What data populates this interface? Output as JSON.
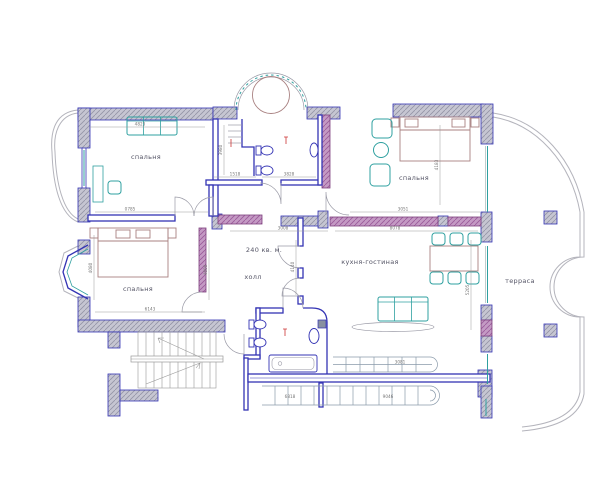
{
  "plan": {
    "area_label": "240 кв. м.",
    "rooms": {
      "bedroom_top_left": "спальня",
      "bedroom_top_right": "спальня",
      "bedroom_left": "спальня",
      "hall": "холл",
      "kitchen_living": "кухня-гостиная",
      "terrace": "терраса"
    },
    "dimensions": {
      "d_sofa": "4823",
      "d_br1_bottom": "0785",
      "d_closet_v": "3980",
      "d_closet": "1518",
      "d_bath": "3828",
      "d_br2_v": "4183",
      "d_br2": "3051",
      "d_hall_top": "3008",
      "d_kitchen_top": "8078",
      "d_hall_v": "4140",
      "d_hall_v2": "4600",
      "d_br3_v": "4080",
      "d_br3": "6143",
      "d_kitchen_v": "5205",
      "d_counter": "3081",
      "d_balcony": "9046",
      "d_balcony_l": "6818"
    },
    "colors": {
      "wall_blue": "#3434b4",
      "wall_gray_fill": "#c6c6d2",
      "wall_purple_fill": "#c49ac4",
      "furniture_teal": "#2fa0a0",
      "furniture_brown": "#a88080",
      "accent_red": "#cc3333",
      "dimension_gray": "#999999"
    }
  }
}
